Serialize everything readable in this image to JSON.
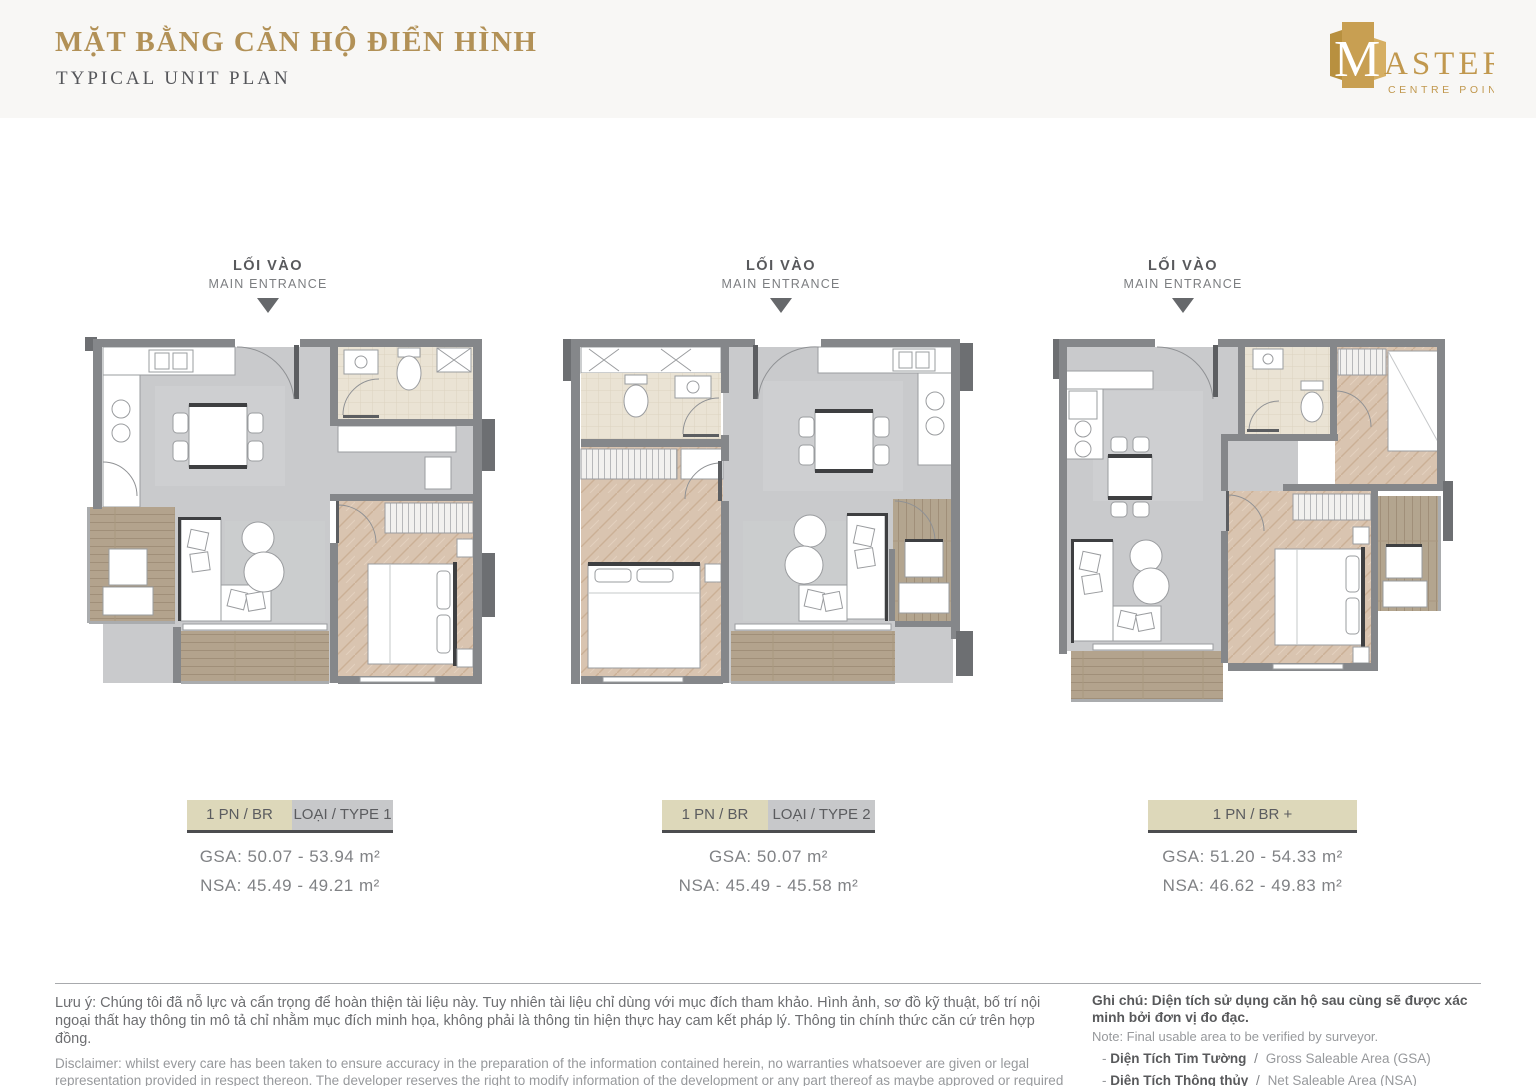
{
  "header": {
    "title_vi": "MẶT BẰNG CĂN HỘ ĐIỂN HÌNH",
    "title_en": "TYPICAL UNIT PLAN"
  },
  "logo": {
    "initial": "M",
    "rest": "ASTERI",
    "tagline": "CENTRE POINT"
  },
  "entrance": {
    "vi": "LỐI VÀO",
    "en": "MAIN ENTRANCE"
  },
  "plans": [
    {
      "bedroom_label": "1 PN / BR",
      "type_label": "LOẠI / TYPE 1",
      "gsa": "GSA: 50.07 - 53.94 m²",
      "nsa": "NSA: 45.49 - 49.21 m²"
    },
    {
      "bedroom_label": "1 PN / BR",
      "type_label": "LOẠI / TYPE 2",
      "gsa": "GSA: 50.07 m²",
      "nsa": "NSA: 45.49 - 45.58 m²"
    },
    {
      "bedroom_label": "1 PN / BR +",
      "gsa": "GSA: 51.20 - 54.33 m²",
      "nsa": "NSA: 46.62 - 49.83 m²"
    }
  ],
  "footer": {
    "note_vi": "Lưu ý: Chúng tôi đã nỗ lực và cẩn trọng để hoàn thiện tài liệu này. Tuy nhiên tài liệu chỉ dùng với mục đích tham khảo. Hình ảnh, sơ đồ kỹ thuật, bố trí nội ngoại thất hay thông tin mô tả chỉ nhằm mục đích minh họa, không phải là thông tin hiện thực hay cam kết pháp lý. Thông tin chính thức căn cứ trên hợp đồng.",
    "disclaimer_en": "Disclaimer: whilst every care has been taken to ensure accuracy in the preparation of the information contained herein, no warranties whatsoever are given or legal representation provided in respect thereon. The developer reserves the right to modify information of the development or any part thereof as maybe approved or required by the relevant authorities.",
    "note_right_vi": "Ghi chú: Diện tích sử dụng căn hộ sau cùng sẽ được xác minh bởi đơn vị đo đạc.",
    "note_right_en": "Note: Final usable area to be verified by surveyor.",
    "bullet": "-",
    "separator": "/",
    "legend": [
      {
        "vi": "Diện Tích Tim Tường",
        "en": "Gross Saleable Area (GSA)"
      },
      {
        "vi": "Diện Tích Thông thủy",
        "en": "Net Saleable Area (NSA)"
      }
    ]
  },
  "colors": {
    "brand_gold": "#b29157",
    "label_beige": "#ddd8ba",
    "label_gray": "#c7c8ca",
    "wall_gray": "#85878a",
    "floor_gray": "#c9cacc",
    "wood": "#d9c4b0",
    "deck": "#b3a38d",
    "bath": "#eae3d4"
  }
}
